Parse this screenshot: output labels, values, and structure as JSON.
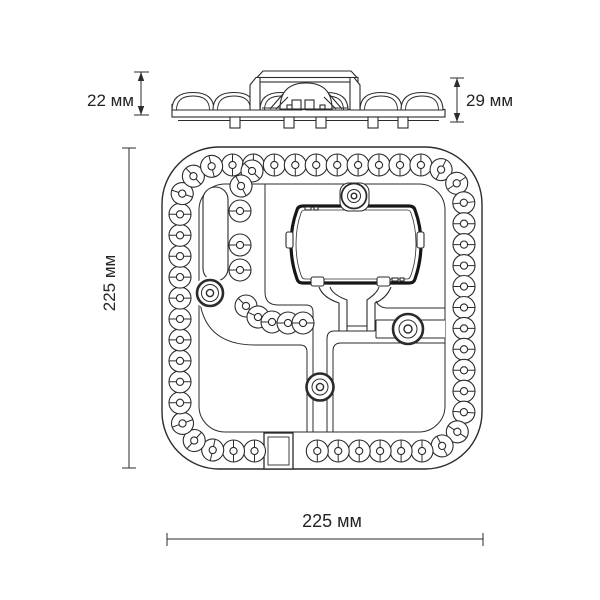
{
  "page": {
    "background": "#ffffff"
  },
  "drawing": {
    "type": "technical-dimension-drawing",
    "subject": "led-module",
    "units": "мм",
    "labels": {
      "side_height_left": "22 мм",
      "side_height_right": "29 мм",
      "plan_height": "225 мм",
      "plan_width": "225 мм"
    },
    "colors": {
      "line": "#2b2b2b",
      "driver_box_outline": "#161616",
      "background": "#ffffff"
    },
    "views": {
      "side": "side-profile-view",
      "plan": "top-plan-view"
    }
  }
}
